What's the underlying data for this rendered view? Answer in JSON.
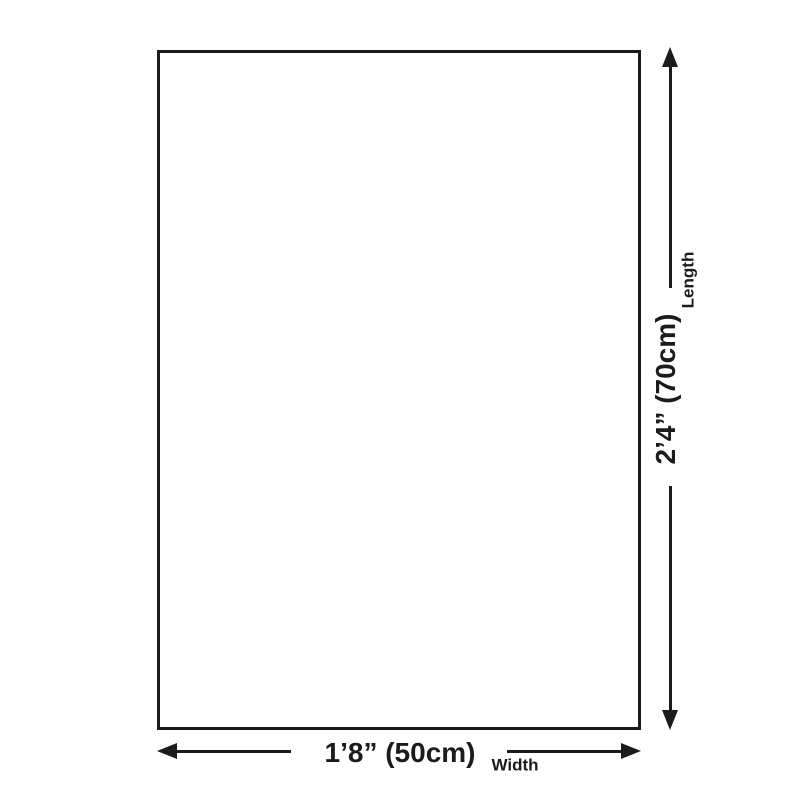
{
  "diagram": {
    "type": "product-dimensions",
    "dimensions": {
      "length": {
        "value": "2’4” (70cm)",
        "label": "Length"
      },
      "width": {
        "value": "1’8” (50cm)",
        "label": "Width"
      }
    },
    "colors": {
      "line": "#1b1b1b",
      "background": "#ffffff"
    }
  }
}
